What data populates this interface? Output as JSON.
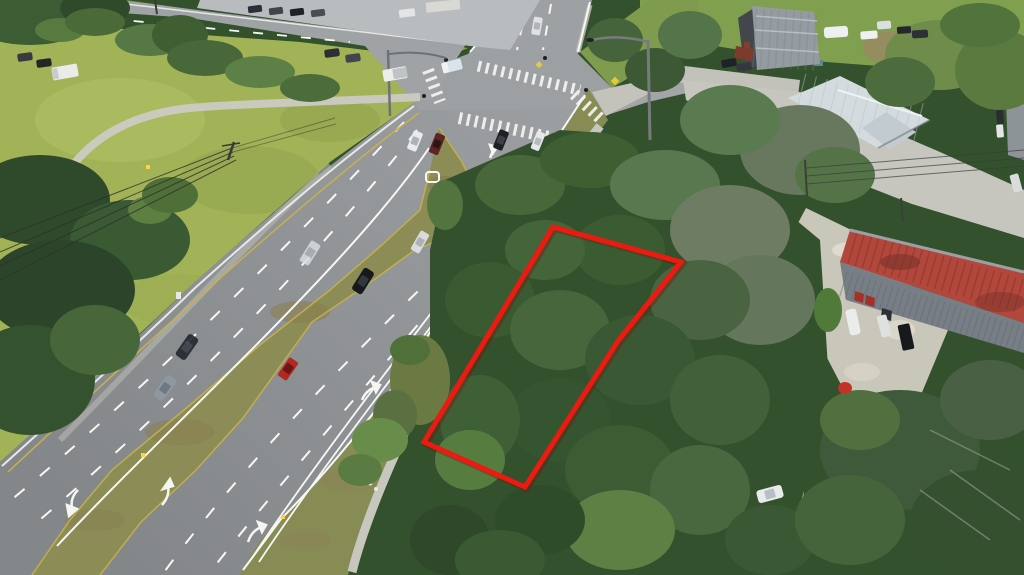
{
  "scene": {
    "type": "aerial-drone-photograph",
    "subject": "vacant treed land parcel outlined in red beside a divided highway",
    "setting": "suburban commercial corridor with signalized intersection, buildings, gravel yards and dense tree canopy"
  },
  "colors": {
    "field_grass": "#a2b357",
    "verge_grass": "#8aa04e",
    "lawn_green": "#81a04f",
    "shoulder_grass": "#878c55",
    "median_grass": "#8b8c56",
    "asphalt": "#8b8e91",
    "asphalt_light": "#9ea1a4",
    "concrete": "#c6c6bf",
    "gravel": "#c9c6ba",
    "sand_path": "#cfc1a4",
    "tree_dark": "#33512c",
    "tree_left": "#2f4a2b",
    "oak_gray_green": "#6d7c63",
    "marking_white": "#f7f7f5",
    "marking_yellow": "#c9b04a",
    "roof_red": "#b2473c",
    "roof_white": "#d4dbde",
    "roof_gray": "#959ca1",
    "parcel_red": "#ec1a10"
  },
  "parcel": {
    "outline_points": "553,227 681,262 618,341 525,487 424,442",
    "outline_color": "#ec1a10",
    "contains": "small light-roofed structure near the road frontage, rest covered by tree canopy"
  },
  "roads": {
    "main_road": "multi-lane divided highway running diagonally from top intersection to bottom-left, grass median with turn lanes",
    "cross_street": "side street meeting the highway at a signalized intersection with continental crosswalks",
    "markings": [
      "white dashed lane lines",
      "white turn arrows",
      "yellow median edge lines",
      "crosswalk bars"
    ]
  },
  "vehicles": {
    "on_highway": 11,
    "on_cross_street": 7,
    "parked": 19,
    "notable": [
      "white box truck",
      "red compact car",
      "white SUV parked in dirt clearing",
      "white camper trailer"
    ]
  },
  "buildings": {
    "gray_workshop": "gray corrugated metal roof, top right",
    "white_metal_building": "white standing-seam metal roof partly under oak canopy, center right",
    "red_roof_warehouse": "long red corrugated roof with gray corrugated wall and red doors, right side",
    "parcel_structure": "small pale shed/mobile-home roof inside red outline"
  }
}
